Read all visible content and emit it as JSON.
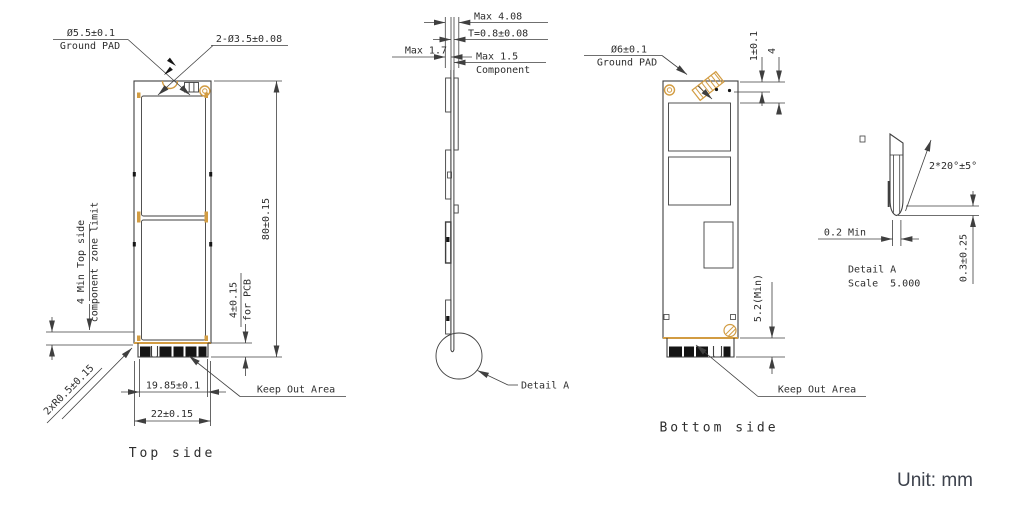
{
  "unit_label": "Unit: mm",
  "colors": {
    "line": "#3f3f3f",
    "gold": "#d29c42",
    "ink": "#151515",
    "text": "#2d2d2d",
    "unit_text": "#3d424c"
  },
  "top_view": {
    "caption": "Top side",
    "ground_pad_label": "Ø5.5±0.1",
    "ground_pad_sublabel": "Ground PAD",
    "holes_label": "2-Ø3.5±0.08",
    "length_dim": "80±0.15",
    "pcb_edge_dim": "4±0.15",
    "pcb_edge_dim_sub": "for PCB",
    "finger_width_dim": "19.85±0.1",
    "board_width_dim": "22±0.15",
    "corner_radius_label": "2xR0.5±0.15",
    "component_zone_label_1": "4 Min Top side",
    "component_zone_label_2": "component zone limit",
    "keep_out_label": "Keep Out Area"
  },
  "side_view": {
    "overall_thickness_dim": "Max 4.08",
    "pcb_thickness_dim": "T=0.8±0.08",
    "left_component_dim": "Max 1.7",
    "right_component_dim": "Max 1.5",
    "right_component_dim_sub": "Component",
    "detail_callout": "Detail A"
  },
  "bottom_view": {
    "caption": "Bottom side",
    "ground_pad_label": "Ø6±0.1",
    "ground_pad_sublabel": "Ground PAD",
    "pad_offset_dim": "1±0.1",
    "pad_height_dim": "4",
    "component_zone_dim": "5.2(Min)",
    "keep_out_label": "Keep Out Area"
  },
  "detail_a": {
    "title": "Detail A",
    "scale": "Scale  5.000",
    "chamfer_angle_label": "2*20°±5°",
    "edge_thickness_dim": "0.2 Min",
    "chamfer_height_dim": "0.3±0.25"
  }
}
